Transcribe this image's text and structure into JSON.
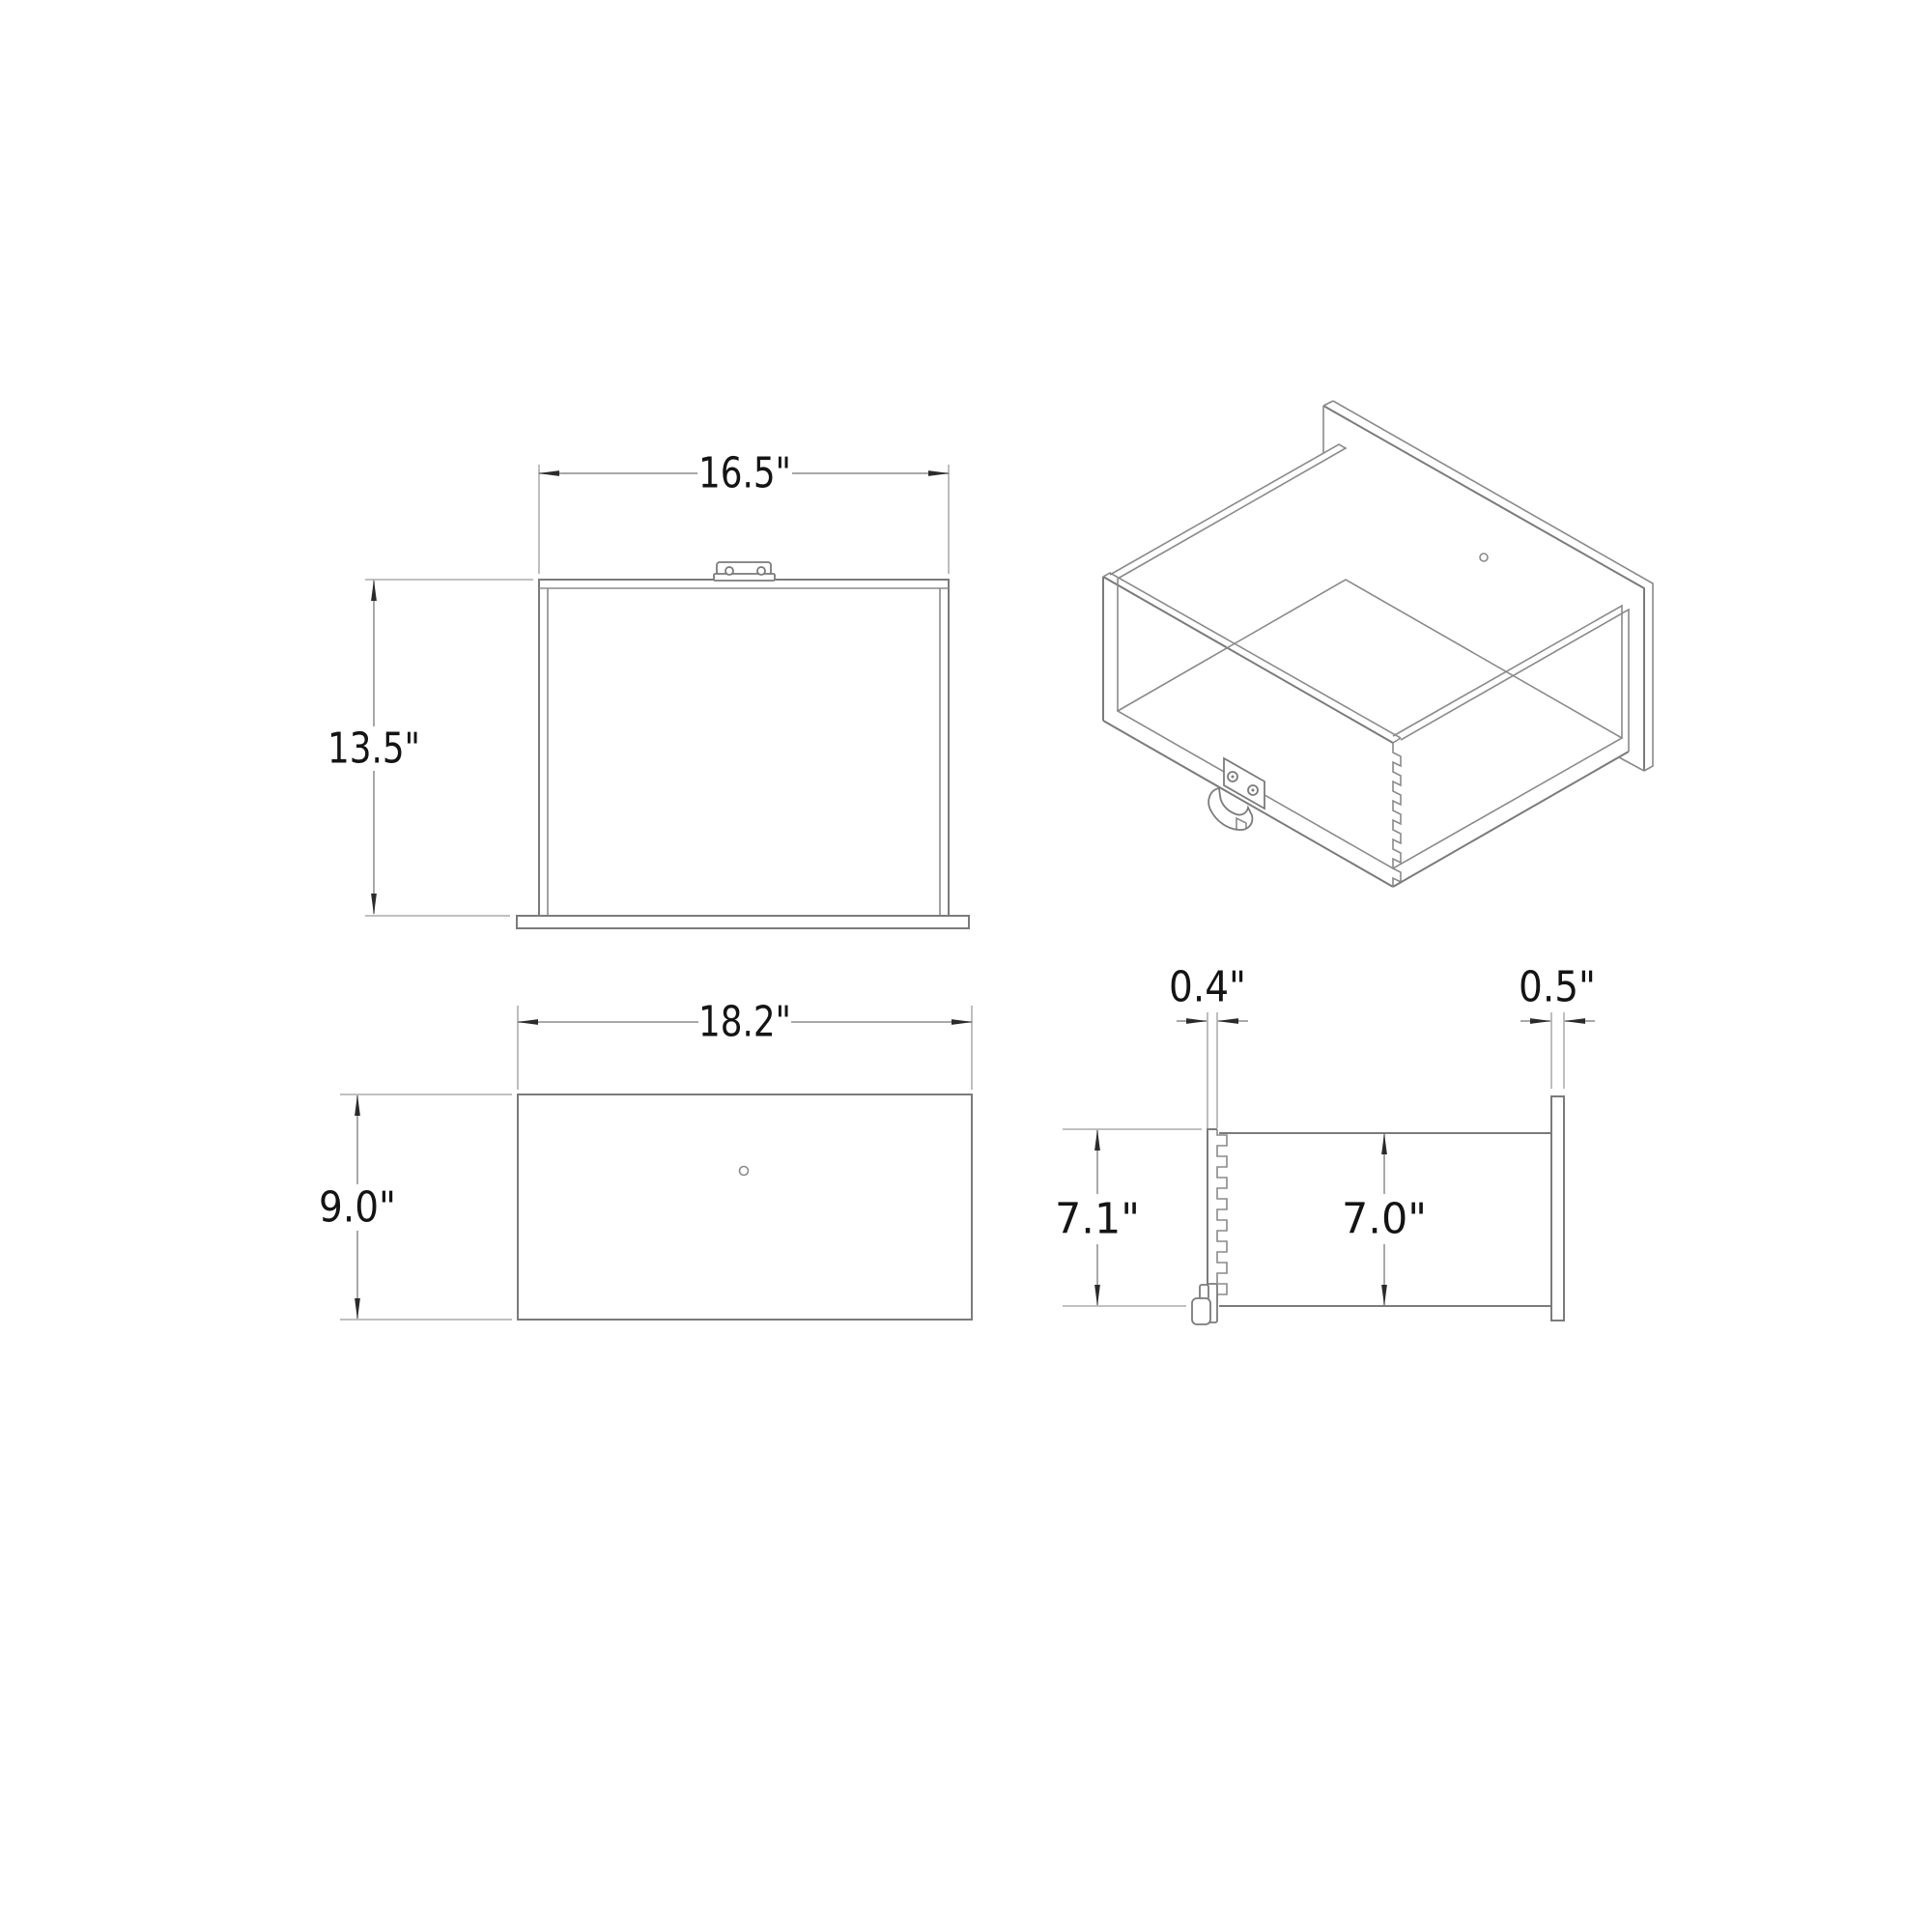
{
  "diagram": {
    "type": "drawer-dimension-drawing",
    "unit": "inches",
    "front_view": {
      "width_label": "16.5\"",
      "height_label": "13.5\""
    },
    "faceplate_view": {
      "width_label": "18.2\"",
      "height_label": "9.0\""
    },
    "side_view": {
      "back_panel_thickness_label": "0.4\"",
      "faceplate_thickness_label": "0.5\"",
      "back_panel_height_label": "7.1\"",
      "side_panel_height_label": "7.0\""
    }
  }
}
